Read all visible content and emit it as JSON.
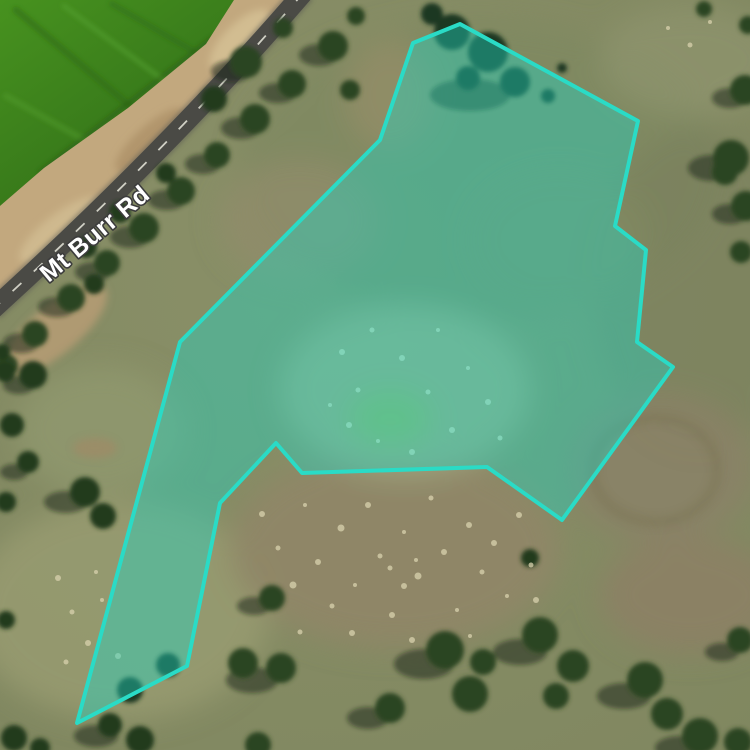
{
  "map": {
    "view_type": "satellite",
    "road_label": {
      "text": "Mt Burr Rd",
      "color": "#ffffff",
      "halo_color": "#3c3c3c",
      "transform": "translate(100,240) rotate(-40)"
    },
    "parcel_overlay": {
      "points": "460,24 638,121 615,226 646,250 637,342 673,367 562,520 487,467 302,473 276,443 220,503 187,666 77,723 180,342 380,140 413,43",
      "stroke_color": "#2adbc6",
      "fill_color": "#20d6c4",
      "fill_opacity": "0.42",
      "stroke_width": "4"
    },
    "terrain_colors": {
      "grass_base": "#868c66",
      "crop_field_green": "#3c7c1f",
      "dirt_sand": "#c2a87e",
      "road_asphalt": "#4a4a45",
      "road_centerline": "#e8e8dc",
      "tree_canopy": "#2c4523",
      "tree_shadow": "#15230f",
      "dry_speckle": "#d9d2ae"
    }
  }
}
